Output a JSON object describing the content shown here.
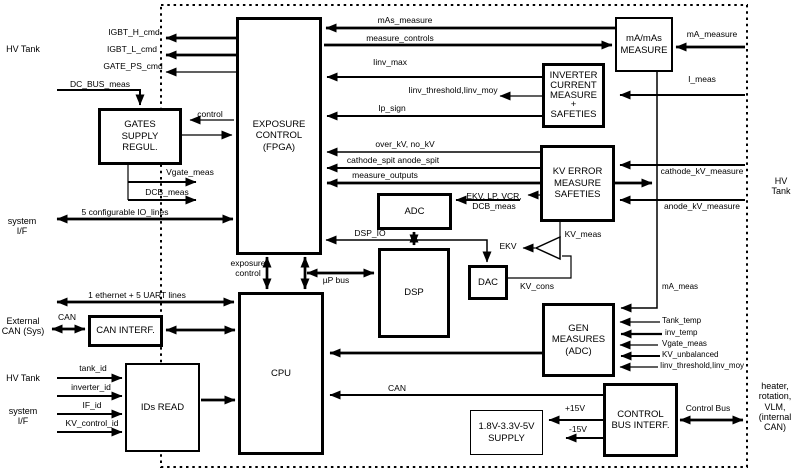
{
  "blocks": {
    "exposure_control": "EXPOSURE\nCONTROL\n(FPGA)",
    "gates_supply": "GATES\nSUPPLY\nREGUL.",
    "ma_mas_measure": "mA/mAs\nMEASURE",
    "inverter_current": "INVERTER\nCURRENT\nMEASURE\n+\nSAFETIES",
    "kv_error": "KV ERROR\nMEASURE\nSAFETIES",
    "adc": "ADC",
    "dsp": "DSP",
    "dac": "DAC",
    "gen_measures": "GEN\nMEASURES\n(ADC)",
    "cpu": "CPU",
    "can_interf": "CAN INTERF.",
    "ids_read": "IDs READ",
    "supply": "1.8V-3.3V-5V\nSUPPLY",
    "control_bus_interf": "CONTROL\nBUS INTERF."
  },
  "signals": {
    "igbt_h_cmd": "IGBT_H_cmd",
    "igbt_l_cmd": "IGBT_L_cmd",
    "gate_ps_cmd": "GATE_PS_cmd",
    "dc_bus_meas": "DC_BUS_meas",
    "control": "control",
    "vgate_meas": "Vgate_meas",
    "dcb_meas": "DCB_meas",
    "io_lines": "5 configurable IO_lines",
    "exposure_control_sig": "exposure\ncontrol",
    "ethernet": "1 ethernet + 5 UART lines",
    "can_left": "CAN",
    "tank_id": "tank_id",
    "inverter_id": "inverter_id",
    "if_id": "IF_id",
    "kv_control_id": "KV_control_id",
    "up_bus": "µP bus",
    "dsp_io": "DSP_IO",
    "mas_measure": "mAs_measure",
    "measure_controls": "measure_controls",
    "ma_measure": "mA_measure",
    "iinv_max": "Iinv_max",
    "iinv_threshold": "Iinv_threshold,Iinv_moy",
    "ip_sign": "Ip_sign",
    "i_meas": "I_meas",
    "over_kv": "over_kV, no_kV",
    "cathode_spit": "cathode_spit anode_spit",
    "measure_outputs": "measure_outputs",
    "adc_inputs": "EKV, LP, VCR,\nDCB_meas",
    "ekv": "EKV",
    "kv_meas": "KV_meas",
    "kv_cons": "KV_cons",
    "cathode_kv_measure": "cathode_kV_measure",
    "anode_kv_measure": "anode_kV_measure",
    "ma_meas": "mA_meas",
    "tank_temp": "Tank_temp",
    "inv_temp": "inv_temp",
    "vgate_meas2": "Vgate_meas",
    "kv_unbalanced": "KV_unbalanced",
    "iinv_threshold2": "Iinv_threshold,Iinv_moy",
    "can_bottom": "CAN",
    "p15v": "+15V",
    "m15v": "-15V",
    "control_bus": "Control Bus"
  },
  "external": {
    "hv_tank_top_left": "HV Tank",
    "system_if_left": "system\nI/F",
    "external_can": "External\nCAN (Sys)",
    "hv_tank_bottom_left": "HV Tank",
    "system_if_bottom": "system\nI/F",
    "hv_tank_right": "HV Tank",
    "internal_can": "heater,\nrotation,\nVLM,\n(internal\nCAN)"
  }
}
